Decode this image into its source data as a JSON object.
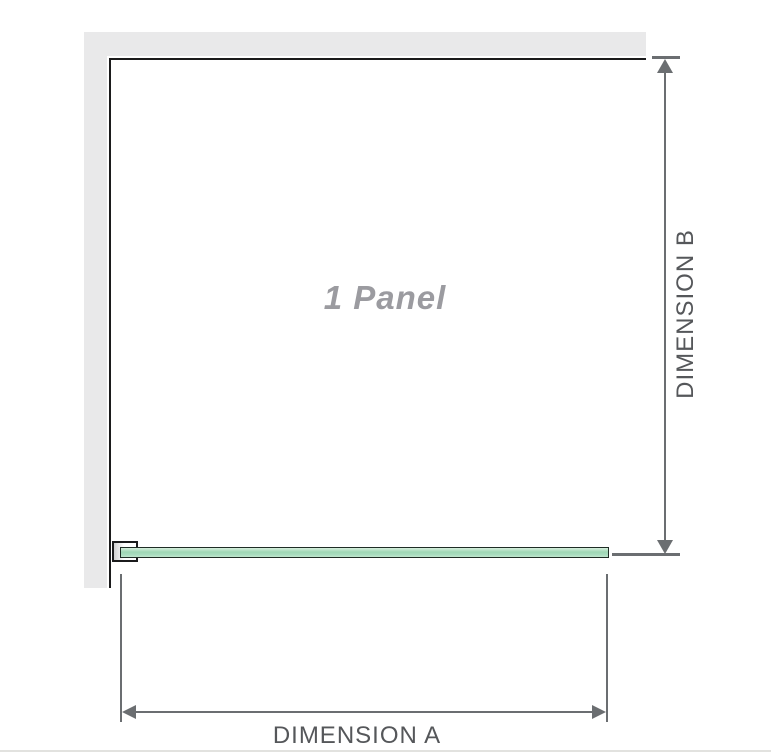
{
  "diagram": {
    "panel_label": "1 Panel",
    "dimensions": {
      "width_label": "DIMENSION A",
      "height_label": "DIMENSION B"
    }
  },
  "colors": {
    "wall_gray": "#e9e9ea",
    "outline_black": "#1b1b1c",
    "dimension_gray": "#6b6e71",
    "label_gray": "#55575a",
    "panel_text_gray": "#9b9ba0",
    "glass_green_light": "#d6eedd",
    "glass_green": "#9ed7b5",
    "glass_border": "#1f2d25",
    "divider_gray": "#e2e2df"
  }
}
